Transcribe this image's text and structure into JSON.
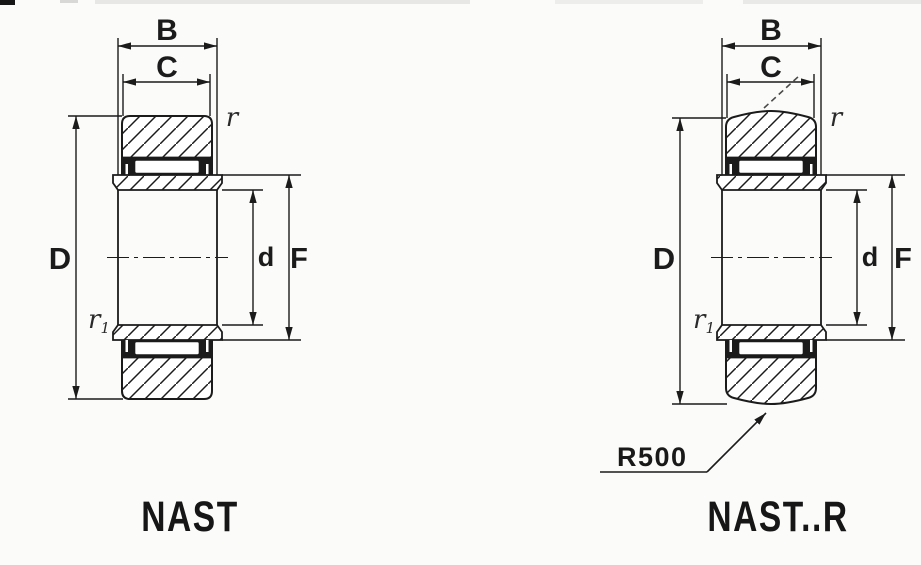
{
  "page": {
    "background_color": "#fbfbf9",
    "ink_color": "#1b1b1b",
    "description_labels_only": "technical bearing cross-section diagram"
  },
  "figures": {
    "nast": {
      "caption": "NAST",
      "dims": {
        "B": "B",
        "C": "C",
        "D": "D",
        "d": "d",
        "F": "F"
      },
      "chamfer": {
        "r": "r",
        "r1": "r",
        "r1_sub": "1"
      }
    },
    "nast_r": {
      "caption": "NAST..R",
      "dims": {
        "B": "B",
        "C": "C",
        "D": "D",
        "d": "d",
        "F": "F"
      },
      "chamfer": {
        "r": "r",
        "r1": "r",
        "r1_sub": "1"
      },
      "crown_radius_label": "R500"
    }
  }
}
